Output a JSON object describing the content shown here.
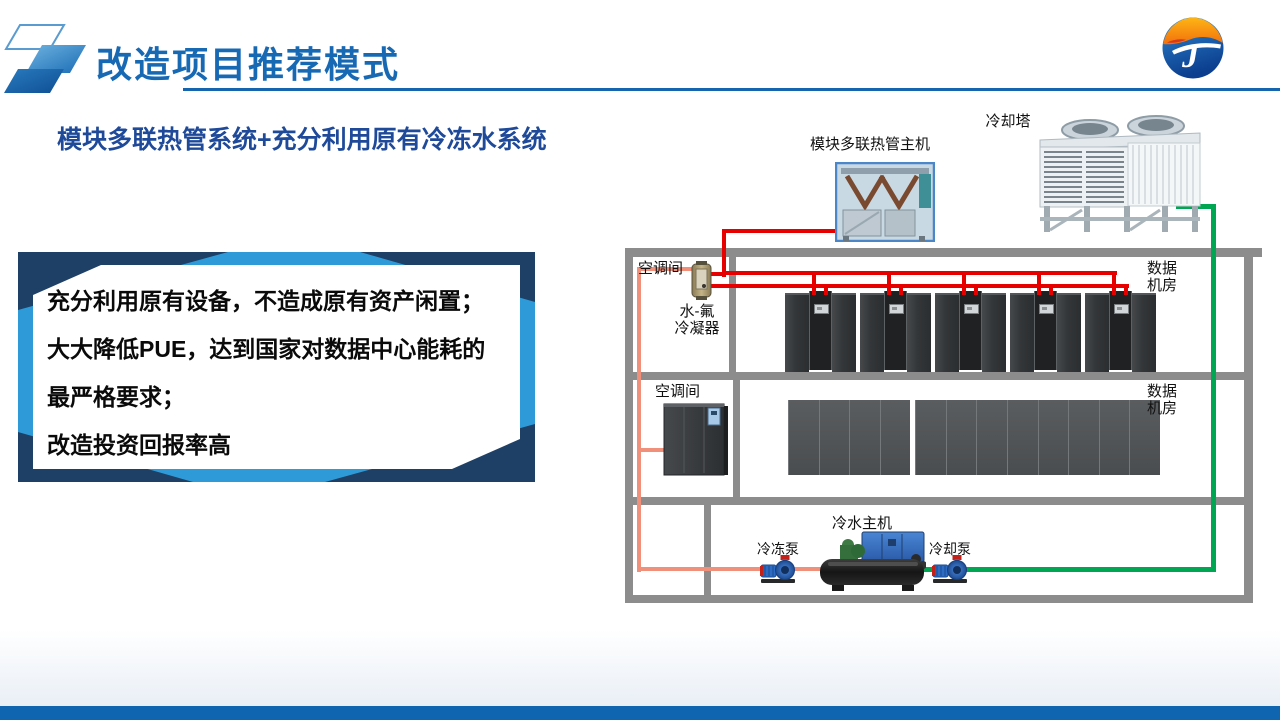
{
  "header": {
    "title": "改造项目推荐模式"
  },
  "logo": {
    "letter": "J"
  },
  "subtitle": "模块多联热管系统+充分利用原有冷冻水系统",
  "benefits": {
    "lines": [
      "充分利用原有设备，不造成原有资产闲置；",
      "大大降低PUE，达到国家对数据中心能耗的",
      "最严格要求；",
      "改造投资回报率高"
    ]
  },
  "diagram": {
    "equipment_labels": {
      "heat_pipe_unit": "模块多联热管主机",
      "cooling_tower": "冷却塔",
      "condenser_l1": "水-氟",
      "condenser_l2": "冷凝器",
      "chiller": "冷水主机",
      "chilled_pump": "冷冻泵",
      "cooling_pump": "冷却泵"
    },
    "room_labels": {
      "ac_room1": "空调间",
      "ac_room2": "空调间",
      "data_room1_l1": "数据",
      "data_room1_l2": "机房",
      "data_room2_l1": "数据",
      "data_room2_l2": "机房"
    },
    "counts": {
      "room1_groups": 5,
      "room2_cabinets": 12
    },
    "colors": {
      "refrigerant_pipe": "#E60000",
      "chilled_water_pipe": "#F0907A",
      "cooling_water_pipe": "#00A651",
      "wall": "#8C8C8C"
    }
  }
}
